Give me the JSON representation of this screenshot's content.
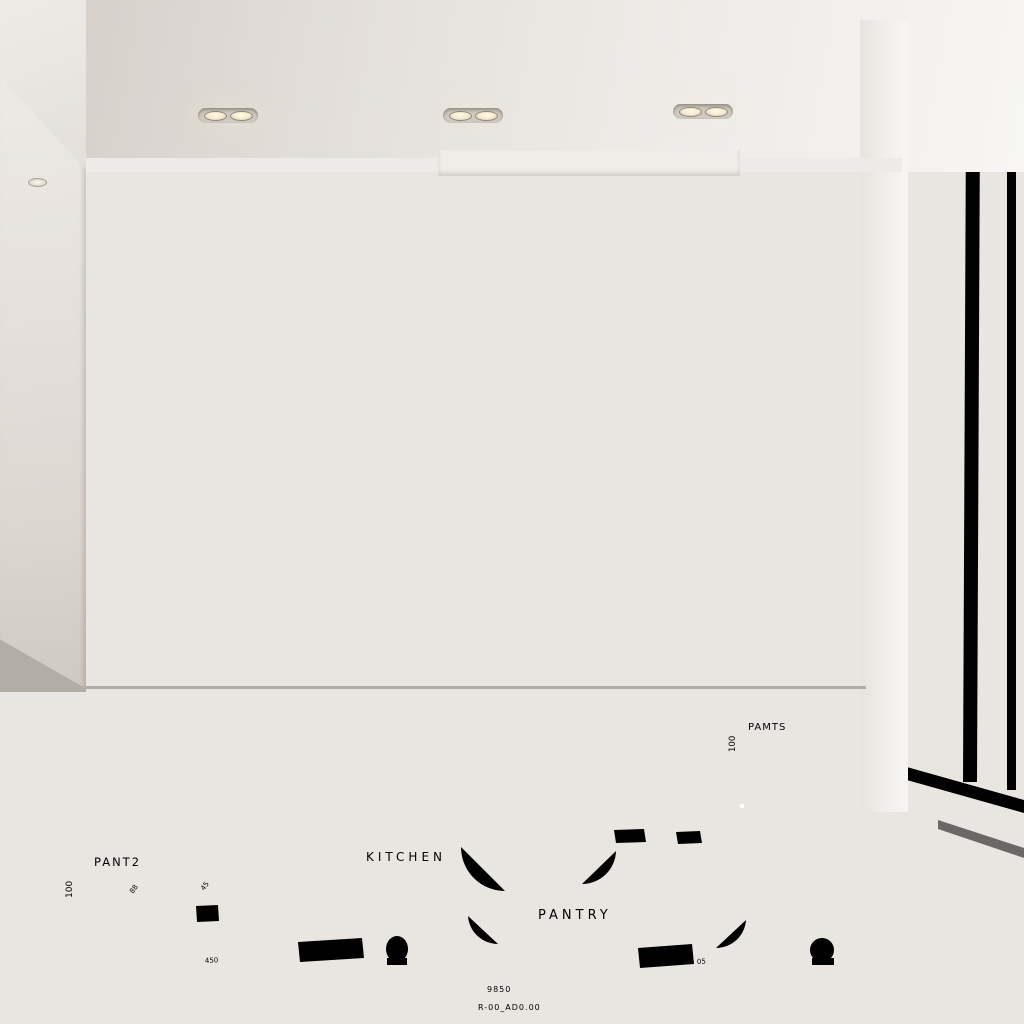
{
  "scene": {
    "type": "photorealistic-kitchen-render",
    "description": "Minimalist kitchen with taupe and light-oak cabinetry, marble waterfall island with integrated cooktop, built-in wall oven and coffee machine, under-cabinet LED lighting, floor-to-ceiling window, and a white architectural blueprint floor plan projected onto the concrete floor"
  },
  "blueprint": {
    "room_labels": {
      "left": "PANT2",
      "kitchen": "KITCHEN",
      "pantry": "PANTRY",
      "island_callout": "PAMTS"
    },
    "dimensions": {
      "left_vertical": "100",
      "island_vertical": "100",
      "bottom_total": "9850",
      "drawing_reference": "R-00_AD0.00",
      "small_a": "45",
      "small_b": "88",
      "small_c": "450",
      "small_d": "05"
    },
    "line_color": "#ffffff"
  },
  "palette": {
    "cabinet_taupe": "#948b7d",
    "cabinet_oak": "#c9ab83",
    "island_oak": "#c2a47d",
    "marble_counter": "#ece8e2",
    "backsplash_marble": "#efe7db",
    "floor_concrete": "#aaa59d",
    "window_frame": "#8c8376",
    "led_glow": "#f7e9cf",
    "appliance_black": "#181614",
    "appliance_steel": "#c8c4bd"
  }
}
